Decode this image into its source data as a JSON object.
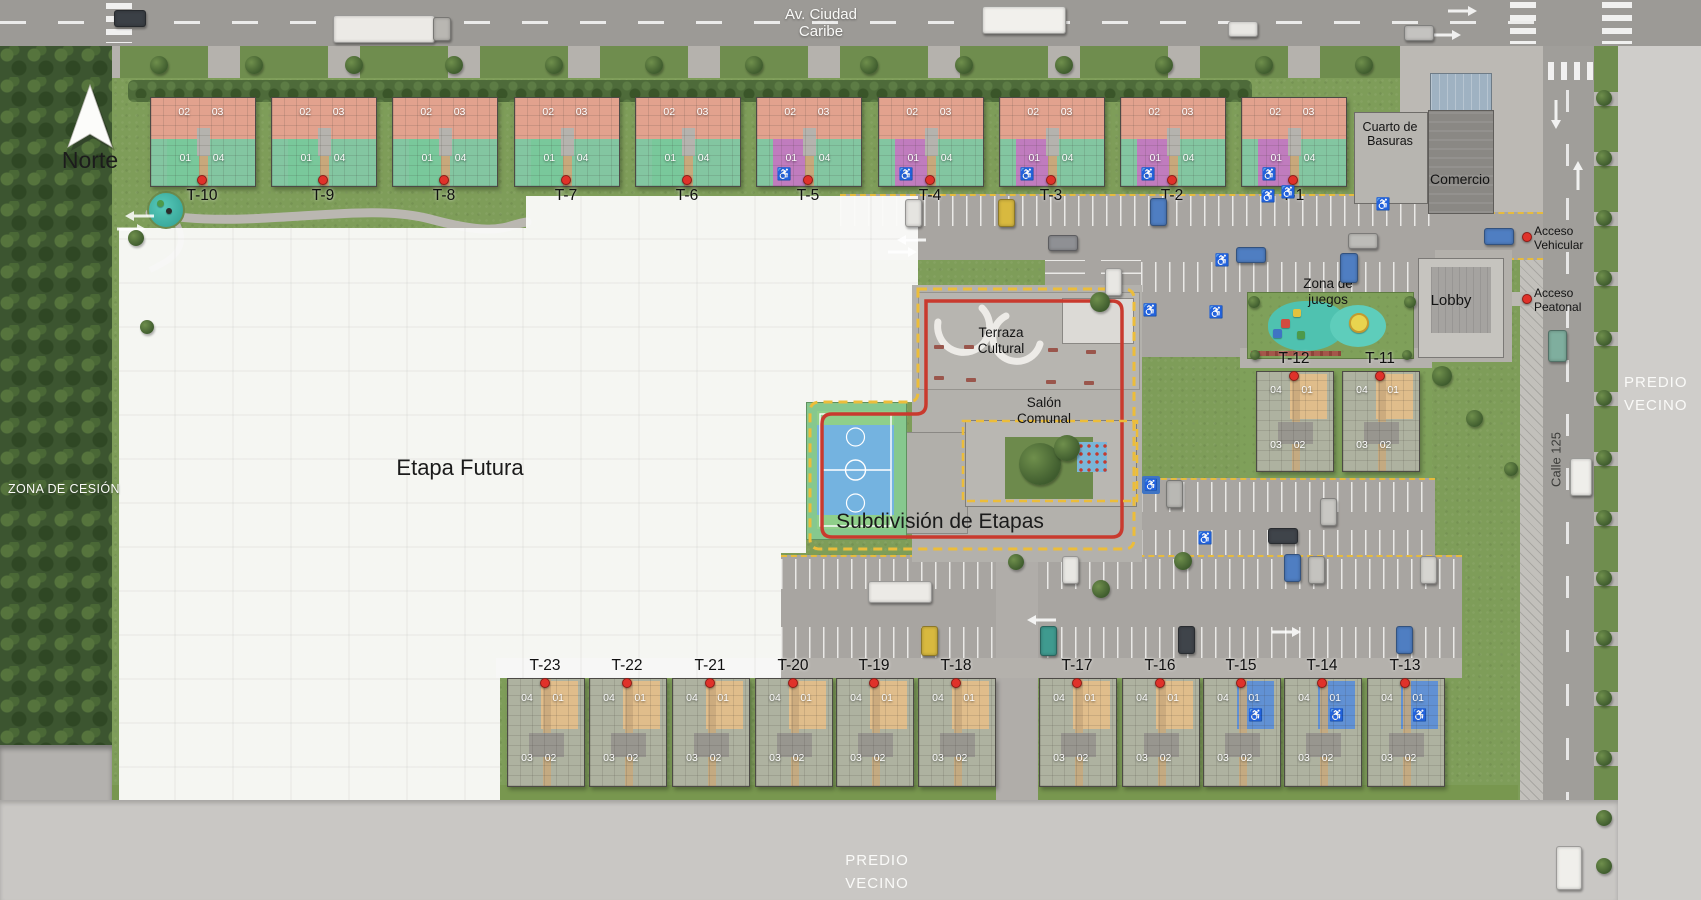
{
  "compass": {
    "label": "Norte"
  },
  "roads": {
    "top": "Av. Ciudad\nCaribe",
    "right_vertical": "Calle 125"
  },
  "zones": {
    "cesion": "ZONA DE CESIÓN",
    "predio_right": "PREDIO\nVECINO",
    "predio_bottom": "PREDIO\nVECINO",
    "etapa_futura": "Etapa Futura",
    "subdivision": "Subdivisión de Etapas"
  },
  "amenities": {
    "terraza": "Terraza\nCultural",
    "salon": "Salón\nComunal",
    "juegos": "Zona de\njuegos",
    "lobby": "Lobby",
    "comercio": "Comercio",
    "basuras": "Cuarto de\nBasuras"
  },
  "access": {
    "vehicular": "Acceso\nVehicular",
    "peatonal": "Acceso\nPeatonal"
  },
  "tower_rows": {
    "north": {
      "labels": [
        "T-10",
        "T-9",
        "T-8",
        "T-7",
        "T-6",
        "T-5",
        "T-4",
        "T-3",
        "T-2",
        "T-1"
      ],
      "accessible": [
        "T-5",
        "T-4",
        "T-3",
        "T-2",
        "T-1"
      ],
      "upper_units": [
        "02",
        "03"
      ],
      "lower_units": [
        "01",
        "04"
      ]
    },
    "east": {
      "labels": [
        "T-12",
        "T-11"
      ],
      "accessible": [],
      "upper_units": [
        "04",
        "01"
      ],
      "lower_units": [
        "03",
        "02"
      ]
    },
    "south": {
      "labels": [
        "T-23",
        "T-22",
        "T-21",
        "T-20",
        "T-19",
        "T-18",
        "T-17",
        "T-16",
        "T-15",
        "T-14",
        "T-13"
      ],
      "accessible": [
        "T-15",
        "T-14",
        "T-13"
      ],
      "upper_units": [
        "04",
        "01"
      ],
      "lower_units": [
        "03",
        "02"
      ]
    }
  },
  "icons": {
    "wheelchair": "♿",
    "north_arrow": "north-arrow",
    "pin": "location-pin"
  },
  "colors": {
    "salmon": "#e2a28e",
    "mint": "#83c6a1",
    "orchid": "#c07cbe",
    "tan": "#e0bd8b",
    "blue": "#6191d4",
    "sage": "#aeb2a0",
    "boundary_yellow": "#ecbd3a",
    "boundary_red": "#c93a2e"
  }
}
